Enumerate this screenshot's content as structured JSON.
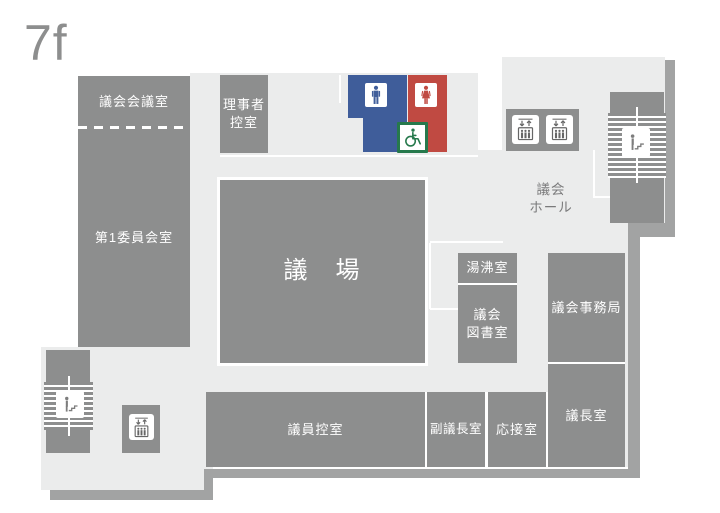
{
  "floor_label": "7f",
  "rooms": {
    "gikai_kaigishitsu": "議会会議室",
    "dai1_iinkaishitsu": "第1委員会室",
    "rijisha_hikaeshitsu": "理事者\n控室",
    "gijou": "議　場",
    "yuwakashishitsu": "湯沸室",
    "gikai_toshoshitsu": "議会\n図書室",
    "gikai_jimukyoku": "議会事務局",
    "gichoushitsu": "議長室",
    "giin_hikaeshitsu": "議員控室",
    "fuku_gichoushitsu": "副議長室",
    "ousetsushitsu": "応接室",
    "gikai_hall": "議会\nホール"
  },
  "icons": {
    "male_toilet": "male-toilet-icon",
    "female_toilet": "female-toilet-icon",
    "accessible_toilet": "wheelchair-icon",
    "elevator": "elevator-icon",
    "stairs": "stairs-icon"
  },
  "colors": {
    "room_gray": "#8d8e8e",
    "floor_gray": "#ebecec",
    "outer_wall_gray": "#a2a3a3",
    "toilet_male_blue": "#3f5d9a",
    "toilet_female_red": "#c04a42",
    "accessible_green": "#26794c"
  }
}
